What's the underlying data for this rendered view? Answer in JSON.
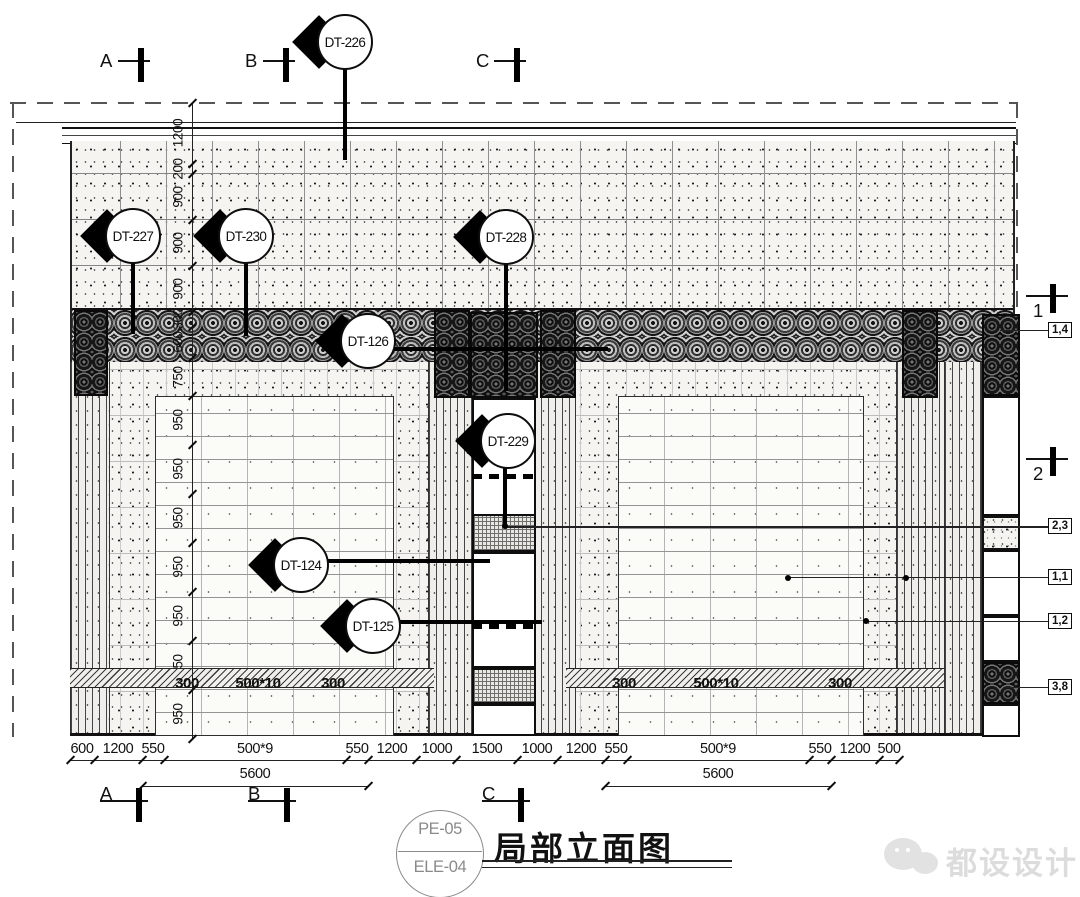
{
  "drawing_title": {
    "sheet_code": "PE-05",
    "elevation_code": "ELE-04",
    "name": "局部立面图"
  },
  "watermark": {
    "brand": "都设设计"
  },
  "sections": {
    "top": [
      "A",
      "B",
      "C"
    ],
    "bottom": [
      "A",
      "B",
      "C"
    ],
    "right": [
      "1",
      "2"
    ]
  },
  "callouts": [
    "DT-226",
    "DT-227",
    "DT-230",
    "DT-228",
    "DT-126",
    "DT-229",
    "DT-124",
    "DT-125"
  ],
  "tags": [
    "1,4",
    "2,3",
    "1,1",
    "1,2",
    "3,8"
  ],
  "dims": {
    "left_vertical": [
      "1200",
      "200",
      "900",
      "900",
      "900",
      "300",
      "600",
      "750",
      "950",
      "950",
      "950",
      "950",
      "950",
      "950",
      "950"
    ],
    "bottom": [
      "600",
      "1200",
      "550",
      "500*9",
      "550",
      "1200",
      "1000",
      "1500",
      "1000",
      "1200",
      "550",
      "500*9",
      "550",
      "1200",
      "500"
    ],
    "bottom_totals": [
      "5600",
      "5600"
    ],
    "wall_left": [
      "300",
      "500*10",
      "300"
    ],
    "wall_right": [
      "300",
      "500*10",
      "300"
    ]
  }
}
